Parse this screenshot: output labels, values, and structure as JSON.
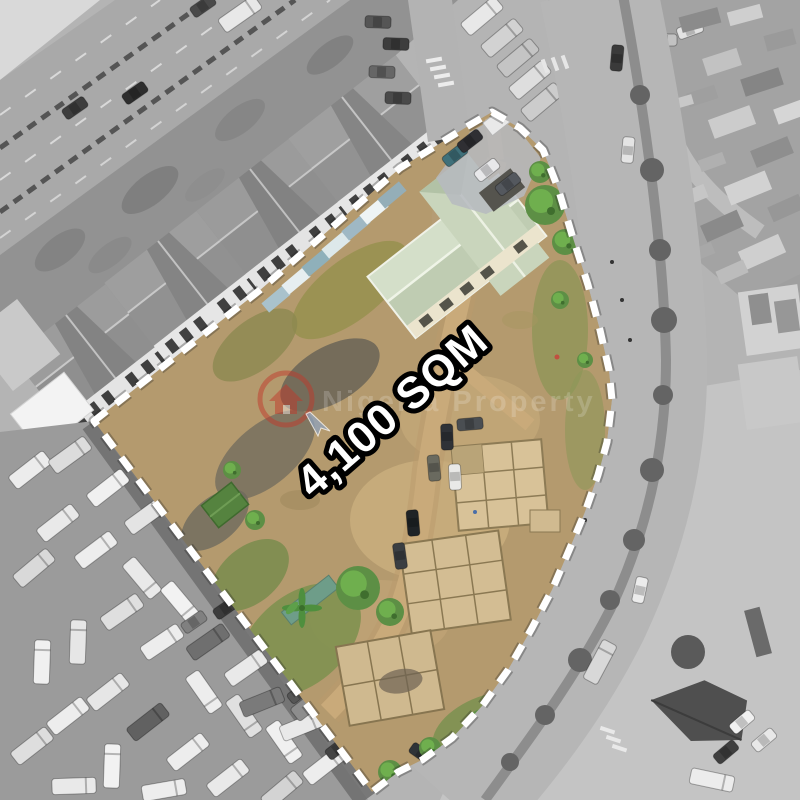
{
  "overlay": {
    "area_label": "4,100 SQM",
    "label_fill": "#ffffff",
    "label_outline": "#000000",
    "boundary_color": "#ffffff",
    "boundary_style": "dashed"
  },
  "watermark": {
    "text": "Nigeria Property",
    "icon": "house-in-circle-with-cursor-icon",
    "icon_color": "#c0392b"
  },
  "scene_colors": {
    "plot_dirt": "#b49a6e",
    "plot_roof_green": "#cbd7c0",
    "shed_green": "#55833f",
    "surroundings_gray": "#b4b4b4",
    "road_gray": "#b6b6b6"
  }
}
